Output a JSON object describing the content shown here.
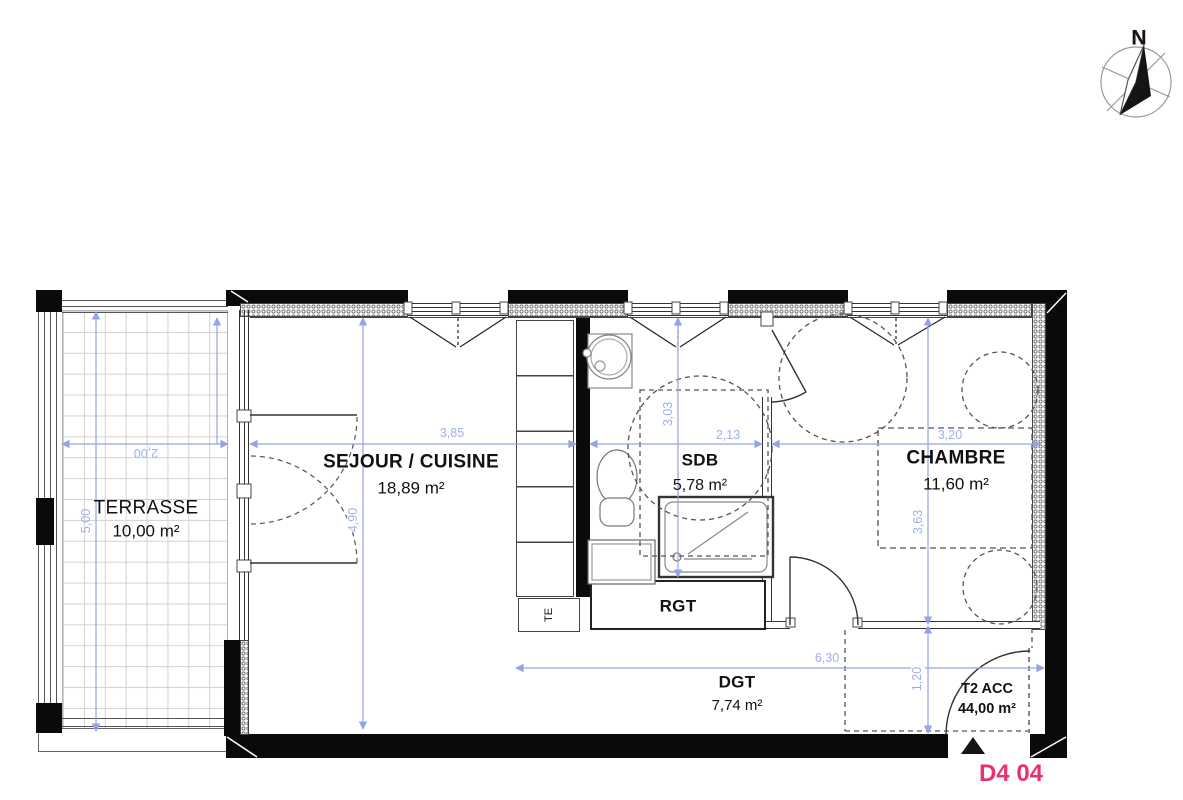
{
  "compass_label": "N",
  "rooms": [
    {
      "name": "TERRASSE",
      "area": "10,00 m²"
    },
    {
      "name": "SEJOUR / CUISINE",
      "area": "18,89 m²"
    },
    {
      "name": "SDB",
      "area": "5,78 m²"
    },
    {
      "name": "CHAMBRE",
      "area": "11,60 m²"
    },
    {
      "name": "RGT"
    },
    {
      "name": "DGT",
      "area": "7,74 m²"
    }
  ],
  "unit": {
    "type_label": "T2 ACC",
    "total_area": "44,00 m²",
    "number": "D4 04"
  },
  "fixtures": {
    "electrical_panel": "TE"
  },
  "dimensions_m": {
    "terrasse_width": "2,00",
    "terrasse_depth": "5,00",
    "sejour_width": "3,85",
    "sejour_depth": "4,90",
    "sdb_width": "2,13",
    "sdb_depth": "3,03",
    "chambre_width": "3,20",
    "chambre_depth": "3,63",
    "dgt_width": "6,30",
    "entry_depth": "1,20"
  },
  "colors": {
    "dimension_blue": "#9db0ec",
    "unit_number_pink": "#e8326b",
    "wall": "#000000"
  }
}
